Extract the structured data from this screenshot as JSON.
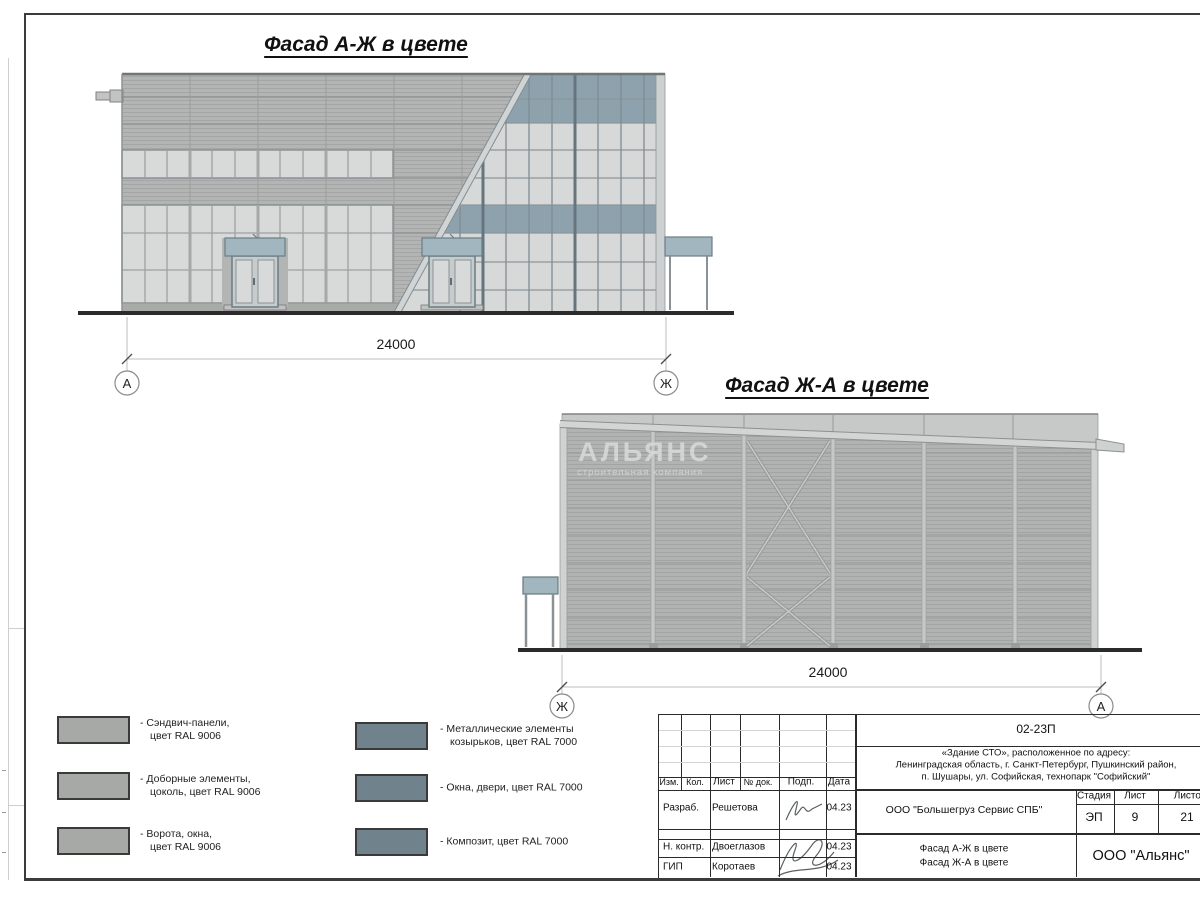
{
  "titles": {
    "facade1": "Фасад А-Ж в цвете",
    "facade2": "Фасад Ж-А в цвете"
  },
  "dimensions": {
    "f1": "24000",
    "f2": "24000"
  },
  "axes": {
    "f1_left": "А",
    "f1_right": "Ж",
    "f2_left": "Ж",
    "f2_right": "А"
  },
  "watermark": {
    "name": "АЛЬЯНС",
    "subtitle": "строительная компания"
  },
  "legend": {
    "items_left": [
      {
        "line1": "- Сэндвич-панели,",
        "line2": "цвет RAL 9006",
        "color": "#a7a9a7"
      },
      {
        "line1": "- Доборные элементы,",
        "line2": "цоколь, цвет RAL 9006",
        "color": "#a7a9a7"
      },
      {
        "line1": "- Ворота, окна,",
        "line2": "цвет RAL 9006",
        "color": "#a7a9a7"
      }
    ],
    "items_right": [
      {
        "line1": "- Металлические элементы",
        "line2": "козырьков, цвет RAL 7000",
        "color": "#70838c"
      },
      {
        "line1": "- Окна, двери, цвет RAL 7000",
        "line2": "",
        "color": "#70838c"
      },
      {
        "line1": "- Композит, цвет RAL 7000",
        "line2": "",
        "color": "#70838c"
      }
    ]
  },
  "title_block": {
    "doc_number": "02-23П",
    "address_line1": "«Здание СТО», расположенное по адресу:",
    "address_line2": "Ленинградская область, г. Санкт-Петербург, Пушкинский район,",
    "address_line3": "п. Шушары, ул. Софийская, технопарк \"Софийский\"",
    "columns": [
      "Изм.",
      "Кол.",
      "Лист",
      "№ док.",
      "Подп.",
      "Дата"
    ],
    "rows": [
      {
        "role": "Разраб.",
        "name": "Решетова",
        "date": "04.23"
      },
      {
        "role": "Н. контр.",
        "name": "Двоеглазов",
        "date": "04.23"
      },
      {
        "role": "ГИП",
        "name": "Коротаев",
        "date": "04.23"
      }
    ],
    "client": "ООО \"Большегруз Сервис СПБ\"",
    "stage_label": "Стадия",
    "sheet_label": "Лист",
    "sheets_label": "Листов",
    "stage": "ЭП",
    "sheet": "9",
    "sheets": "21",
    "sheet_title_line1": "Фасад А-Ж в цвете",
    "sheet_title_line2": "Фасад Ж-А в цвете",
    "company": "ООО \"Альянс\""
  },
  "colors": {
    "panel_ral9006": "#b3b5b4",
    "spandrel_ral7000": "#8da2ad",
    "canopy_ral7000": "#a2b6c0",
    "glass": "#d8dad9",
    "legend_ral9006": "#a7a9a7",
    "legend_ral7000": "#70838c",
    "ground": "#2b2b2b"
  }
}
